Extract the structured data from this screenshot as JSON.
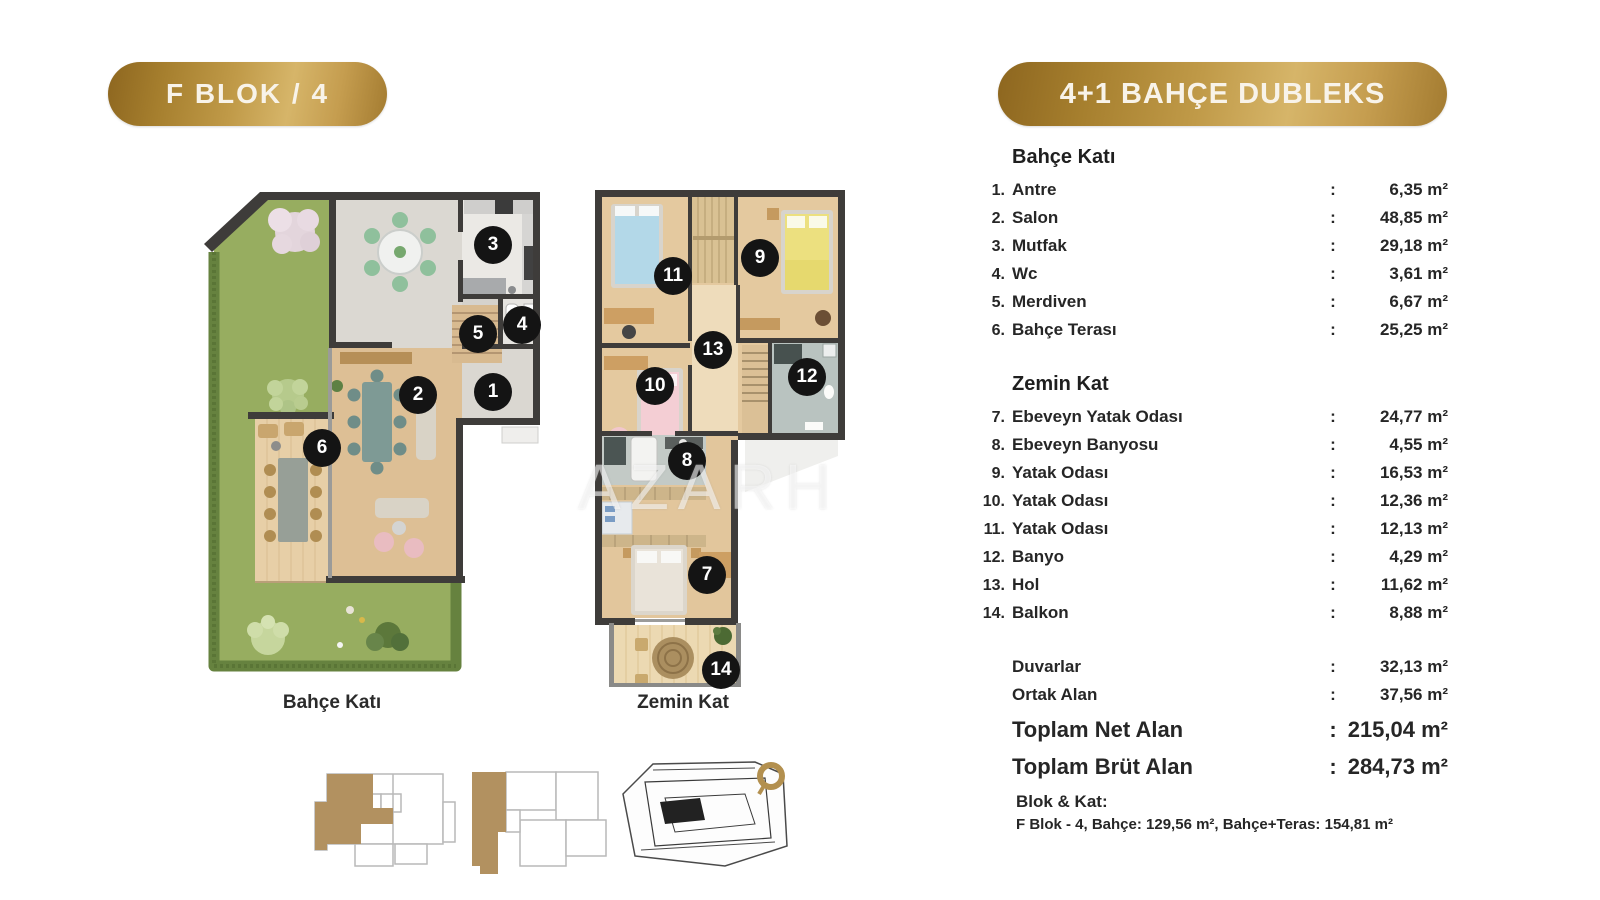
{
  "header": {
    "unit_badge": "F BLOK / 4",
    "type_badge": "4+1 BAHÇE DUBLEKS"
  },
  "separator": ":",
  "watermark": "AZARH",
  "plans": [
    {
      "label": "Bahçe Katı",
      "markers": [
        {
          "n": "1",
          "x": 293,
          "y": 202
        },
        {
          "n": "2",
          "x": 218,
          "y": 205
        },
        {
          "n": "3",
          "x": 293,
          "y": 55
        },
        {
          "n": "4",
          "x": 322,
          "y": 135
        },
        {
          "n": "5",
          "x": 278,
          "y": 144
        },
        {
          "n": "6",
          "x": 122,
          "y": 258
        }
      ]
    },
    {
      "label": "Zemin Kat",
      "markers": [
        {
          "n": "7",
          "x": 112,
          "y": 385
        },
        {
          "n": "8",
          "x": 92,
          "y": 271
        },
        {
          "n": "9",
          "x": 165,
          "y": 68
        },
        {
          "n": "10",
          "x": 60,
          "y": 196
        },
        {
          "n": "11",
          "x": 78,
          "y": 86
        },
        {
          "n": "12",
          "x": 212,
          "y": 187
        },
        {
          "n": "13",
          "x": 118,
          "y": 160
        },
        {
          "n": "14",
          "x": 126,
          "y": 480
        }
      ]
    }
  ],
  "sections": [
    {
      "title": "Bahçe Katı",
      "rows": [
        {
          "num": "1.",
          "label": "Antre",
          "value": "6,35 m²"
        },
        {
          "num": "2.",
          "label": "Salon",
          "value": "48,85 m²"
        },
        {
          "num": "3.",
          "label": "Mutfak",
          "value": "29,18 m²"
        },
        {
          "num": "4.",
          "label": "Wc",
          "value": "3,61 m²"
        },
        {
          "num": "5.",
          "label": "Merdiven",
          "value": "6,67 m²"
        },
        {
          "num": "6.",
          "label": "Bahçe Terası",
          "value": "25,25 m²"
        }
      ]
    },
    {
      "title": "Zemin Kat",
      "rows": [
        {
          "num": "7.",
          "label": "Ebeveyn Yatak Odası",
          "value": "24,77 m²"
        },
        {
          "num": "8.",
          "label": "Ebeveyn Banyosu",
          "value": "4,55 m²"
        },
        {
          "num": "9.",
          "label": "Yatak Odası",
          "value": "16,53 m²"
        },
        {
          "num": "10.",
          "label": "Yatak Odası",
          "value": "12,36 m²"
        },
        {
          "num": "11.",
          "label": "Yatak Odası",
          "value": "12,13 m²"
        },
        {
          "num": "12.",
          "label": "Banyo",
          "value": "4,29 m²"
        },
        {
          "num": "13.",
          "label": "Hol",
          "value": "11,62 m²"
        },
        {
          "num": "14.",
          "label": "Balkon",
          "value": "8,88 m²"
        }
      ]
    }
  ],
  "summary": {
    "rows": [
      {
        "label": "Duvarlar",
        "value": "32,13 m²"
      },
      {
        "label": "Ortak Alan",
        "value": "37,56 m²"
      }
    ],
    "totals": [
      {
        "label": "Toplam Net Alan",
        "value": "215,04 m²"
      },
      {
        "label": "Toplam Brüt Alan",
        "value": "284,73 m²"
      }
    ]
  },
  "footer": {
    "block_label": "Blok & Kat:",
    "block_detail": "F Blok - 4, Bahçe: 129,56 m², Bahçe+Teras: 154,81 m²"
  },
  "colors": {
    "gold_dark": "#8d661f",
    "gold_light": "#d6b569",
    "badge_text": "#f8f3e9",
    "text": "#262626",
    "marker_bg": "#141414",
    "marker_text": "#ffffff",
    "lawn_green": "#97ad60",
    "hedge_green": "#66823f",
    "wood_floor": "#ddbf95",
    "tile_gray": "#b9c3c0",
    "wall_dark": "#3e3c3a",
    "keyplan_highlight": "#b29160"
  }
}
